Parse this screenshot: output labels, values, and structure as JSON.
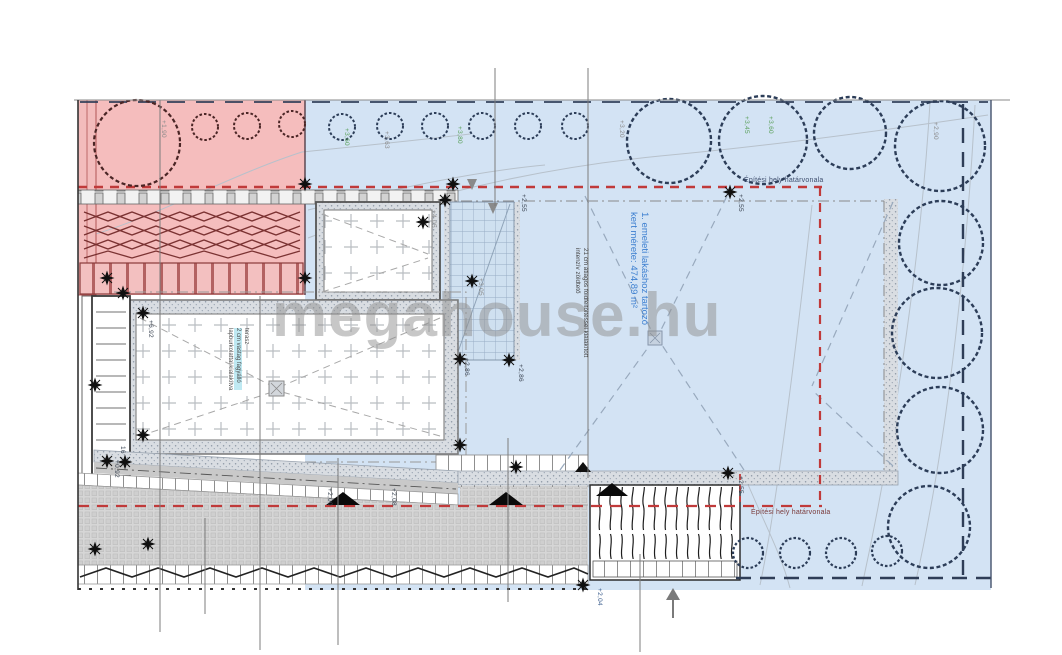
{
  "page": {
    "width": 1062,
    "height": 655,
    "type": "architectural-site-plan"
  },
  "watermark": "megahouse.hu",
  "labels": {
    "boundary_top": "Építési hely határvonala",
    "boundary_bottom": "Építési hely határvonala"
  },
  "notes": {
    "garden_line1": "1. emeleti lakáshoz tartozó",
    "garden_line2": "kert mérete: 474,89 m²",
    "roof_line1": "21 cm átlagos földfeltöltéssel kialakított",
    "roof_line2": "intenzív zöldtető",
    "terrace_line1": "terasz",
    "terrace_line2": "2 cm vastag fagyálló",
    "terrace_line3": "lapburkolattal kialakítva"
  },
  "elevations": {
    "p190": "+1,90",
    "g360": "+3,60",
    "g363": "+3,63",
    "g380": "+3,80",
    "g320": "+3,20",
    "g345": "+3,45",
    "g360b": "+3,60",
    "g290": "+2,90",
    "b255a": "+2,55",
    "b255b": "+2,55",
    "b255c": "+2,55",
    "t405": "+4,05",
    "t305": "+3,05",
    "m286a": "+2,86",
    "m286b": "+2,86",
    "s200": "+2,00",
    "s208": "+2,08",
    "s204": "+2,04",
    "l092": "+0,92",
    "l692": "+6,92",
    "stair_count": "16"
  },
  "colors": {
    "pink": "#f5bdbd",
    "blue": "#d3e3f4",
    "red_dash": "#c03a3a",
    "boundary_dark": "#2e3d57",
    "tree_blue": "#2c3d58",
    "tree_pink": "#4a2525",
    "green_label": "#5aa05a",
    "blue_note": "#3c7fd0",
    "watermark": "#909090"
  }
}
